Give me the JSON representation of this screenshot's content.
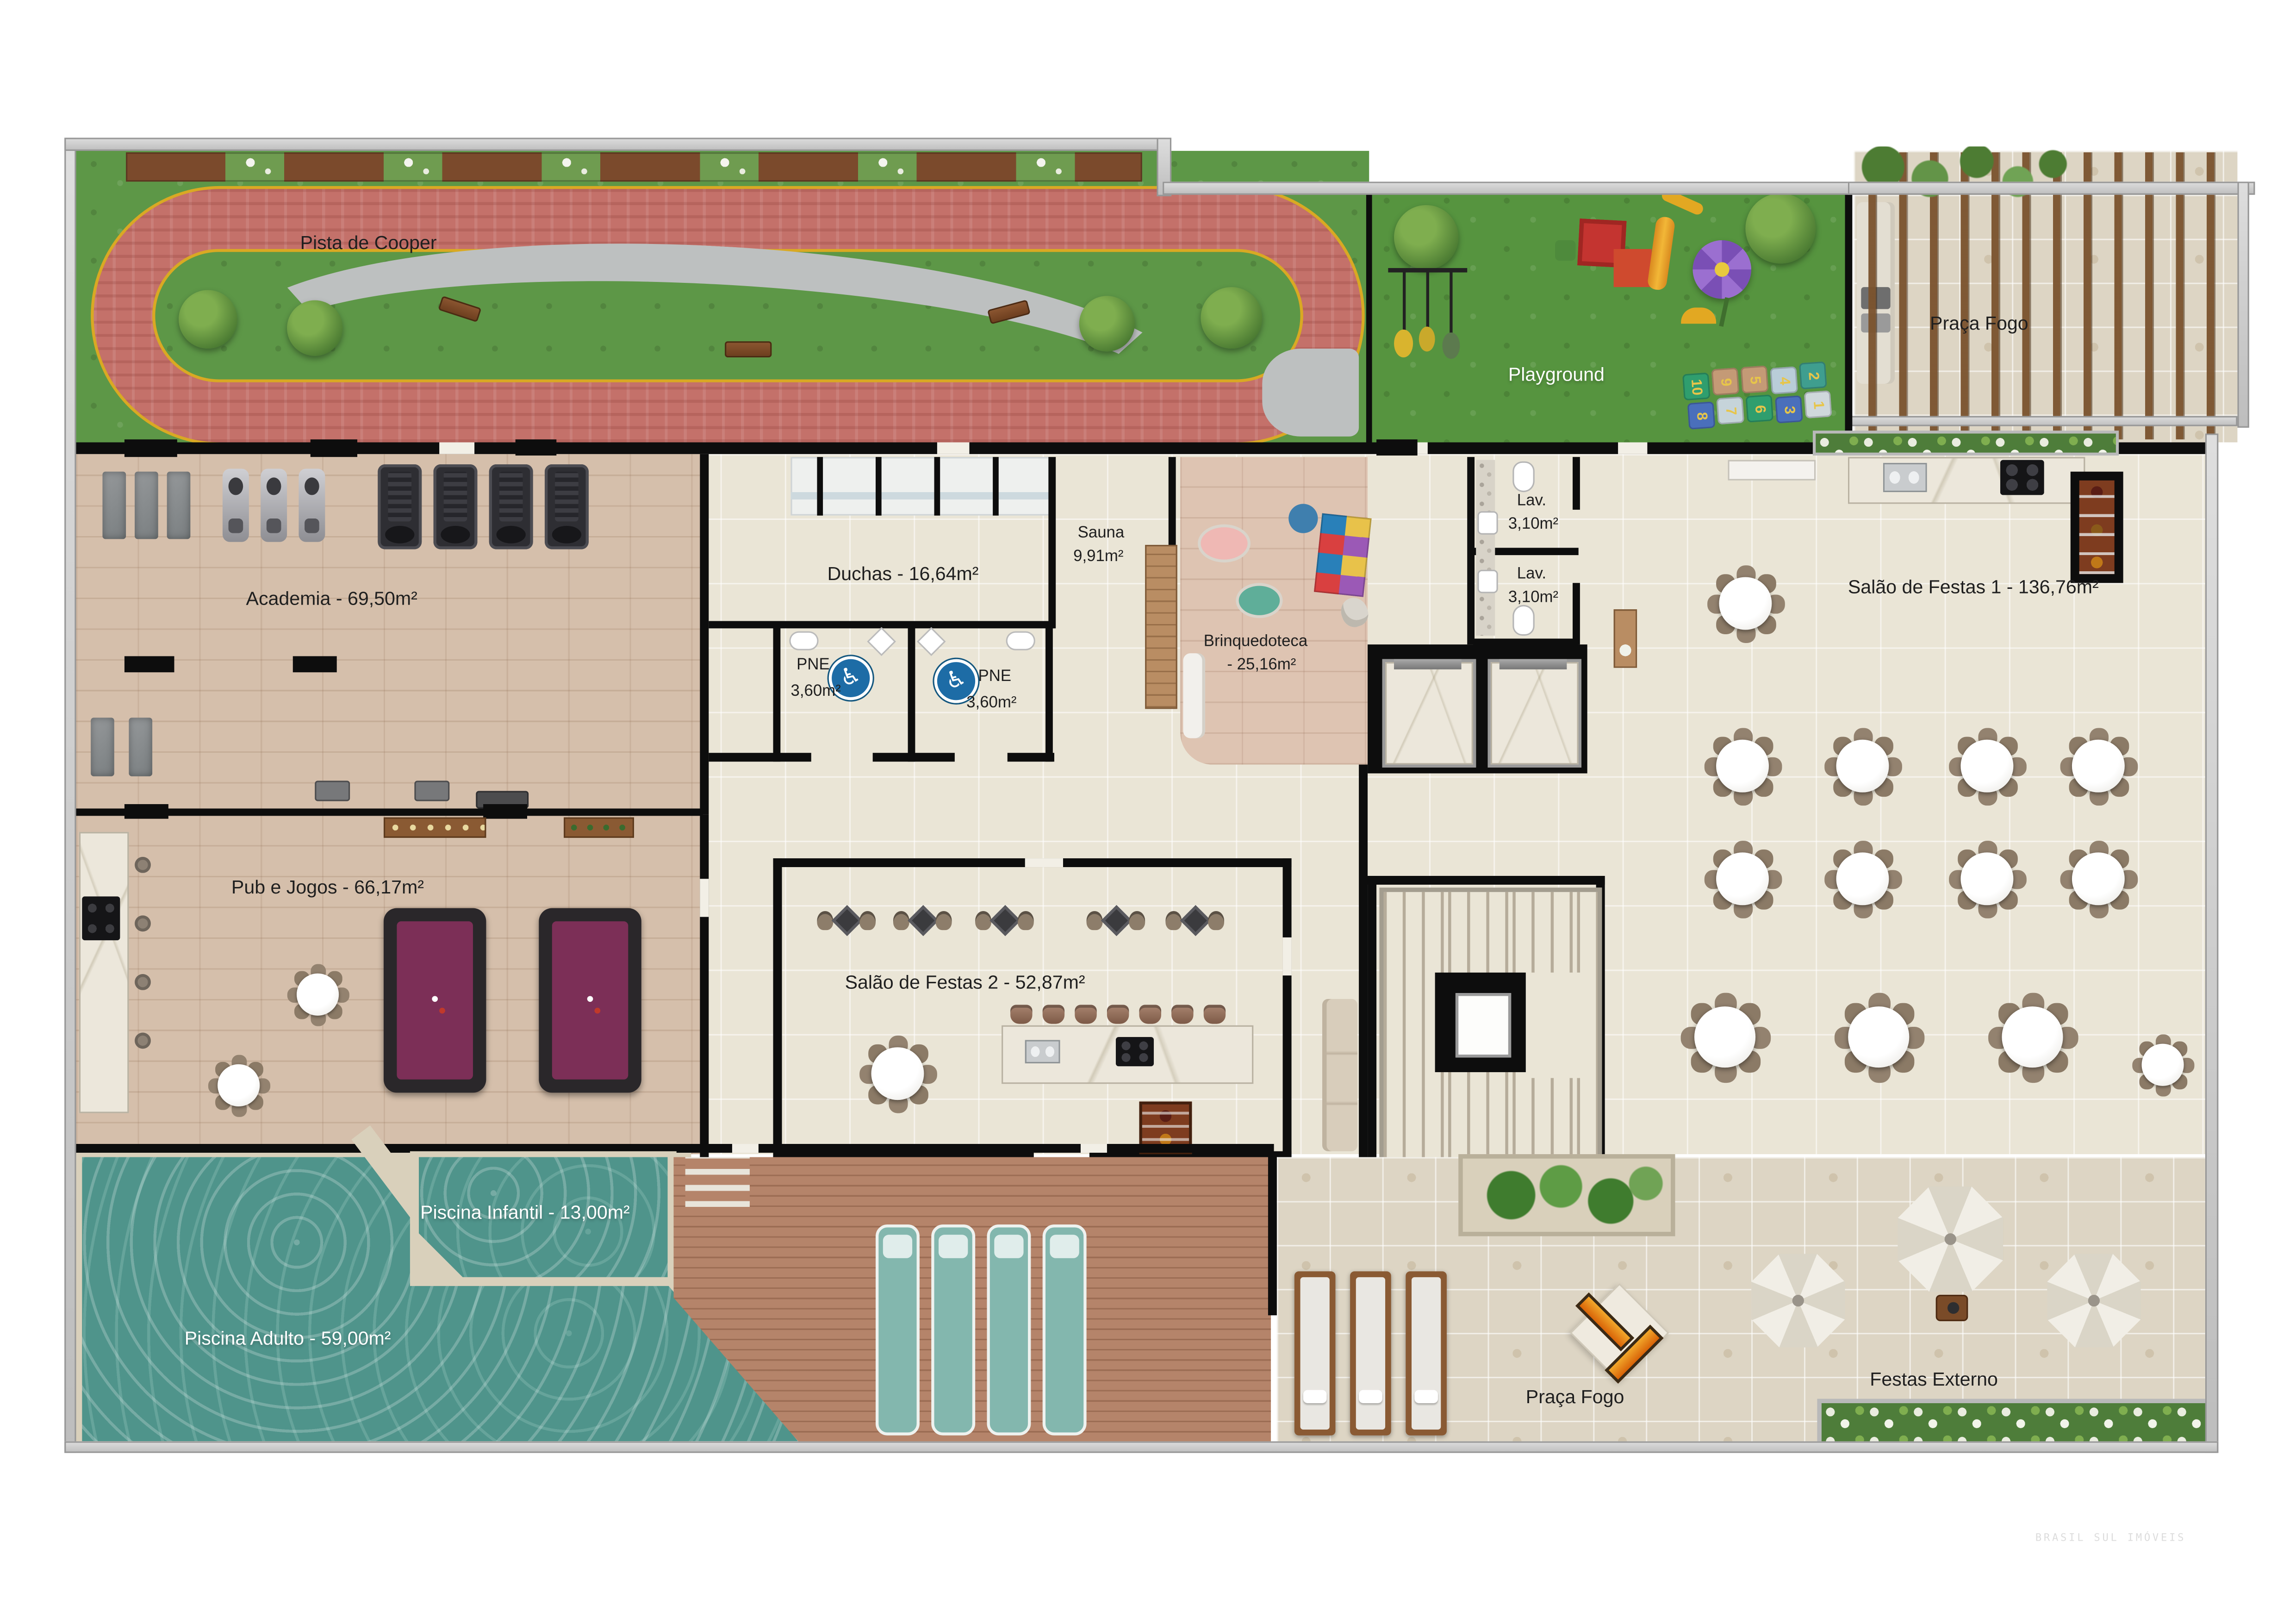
{
  "plan": {
    "watermark": "BRASIL SUL IMÓVEIS",
    "icons": {
      "wheelchair": "♿"
    },
    "labels": {
      "pista": "Pista de Cooper",
      "playground": "Playground",
      "praca_fogo_top": "Praça Fogo",
      "academia": "Academia - 69,50m²",
      "duchas": "Duchas - 16,64m²",
      "sauna_name": "Sauna",
      "sauna_area": "9,91m²",
      "pne_name": "PNE",
      "pne_area": "3,60m²",
      "lav_name": "Lav.",
      "lav_area": "3,10m²",
      "brinquedoteca_name": "Brinquedoteca",
      "brinquedoteca_area": "- 25,16m²",
      "salao1": "Salão de Festas 1 - 136,76m²",
      "salao2": "Salão de Festas 2 - 52,87m²",
      "pub": "Pub e Jogos - 66,17m²",
      "piscina_infantil": "Piscina Infantil - 13,00m²",
      "piscina_adulto": "Piscina Adulto - 59,00m²",
      "praca_fogo_bottom": "Praça Fogo",
      "festas_externo": "Festas Externo"
    },
    "hopscotch": [
      "10",
      "9",
      "5",
      "4",
      "2",
      "8",
      "7",
      "6",
      "3",
      "1"
    ],
    "colors": {
      "grass": "#5d9747",
      "track": "#c4716a",
      "track_line": "#d9a923",
      "path_gray": "#bdc0c0",
      "water": "#4f948b",
      "wood_floor": "#d5bfab",
      "deck": "#b5846a",
      "cream_tile": "#eae5d6",
      "pavers": "#ddd5c4",
      "wall": "#0d0d0d",
      "pne_blue": "#1d6ca6",
      "pool_table": "#7c2f57"
    }
  }
}
